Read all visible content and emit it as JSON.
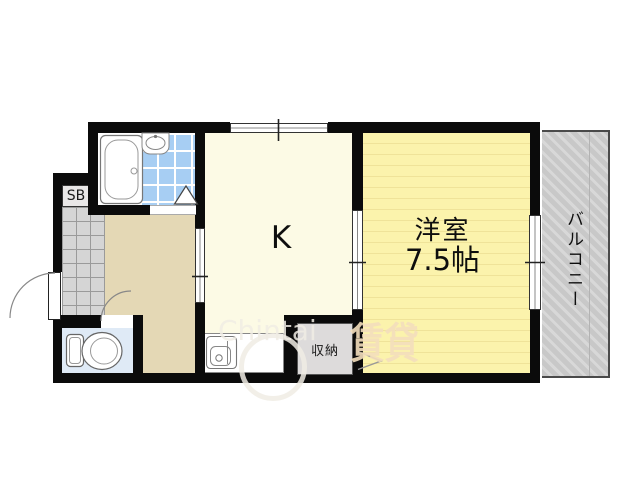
{
  "plan": {
    "type": "apartment-floor-plan",
    "labels": {
      "kitchen": "K",
      "room_name": "洋室",
      "room_size": "7.5帖",
      "balcony": "バルコニー",
      "closet": "収納",
      "shoebox": "SB"
    },
    "watermark": {
      "brand": "Chintai",
      "kanji": "賃貸"
    }
  },
  "colors": {
    "wall": "#0b0b0b",
    "k_floor": "#FCFAE5",
    "west_floor": "#FBF3AC",
    "west_stripe": "#EFE399",
    "hallway": "#E4D8B5",
    "toilet_floor": "#DFEAF6",
    "bath_tile": "#A7CEF3",
    "entrance_tile": "#D5D5D5",
    "entrance_tile_line": "#9A9A9A",
    "balcony": "#C8C8C8",
    "balcony_stripe": "#D8D8D8",
    "box_fill": "#E9E7E7",
    "closet_fill": "#DDDBDB",
    "watermark_light": "rgba(240,236,228,0.85)",
    "watermark_orange": "rgba(243,222,188,0.9)"
  }
}
